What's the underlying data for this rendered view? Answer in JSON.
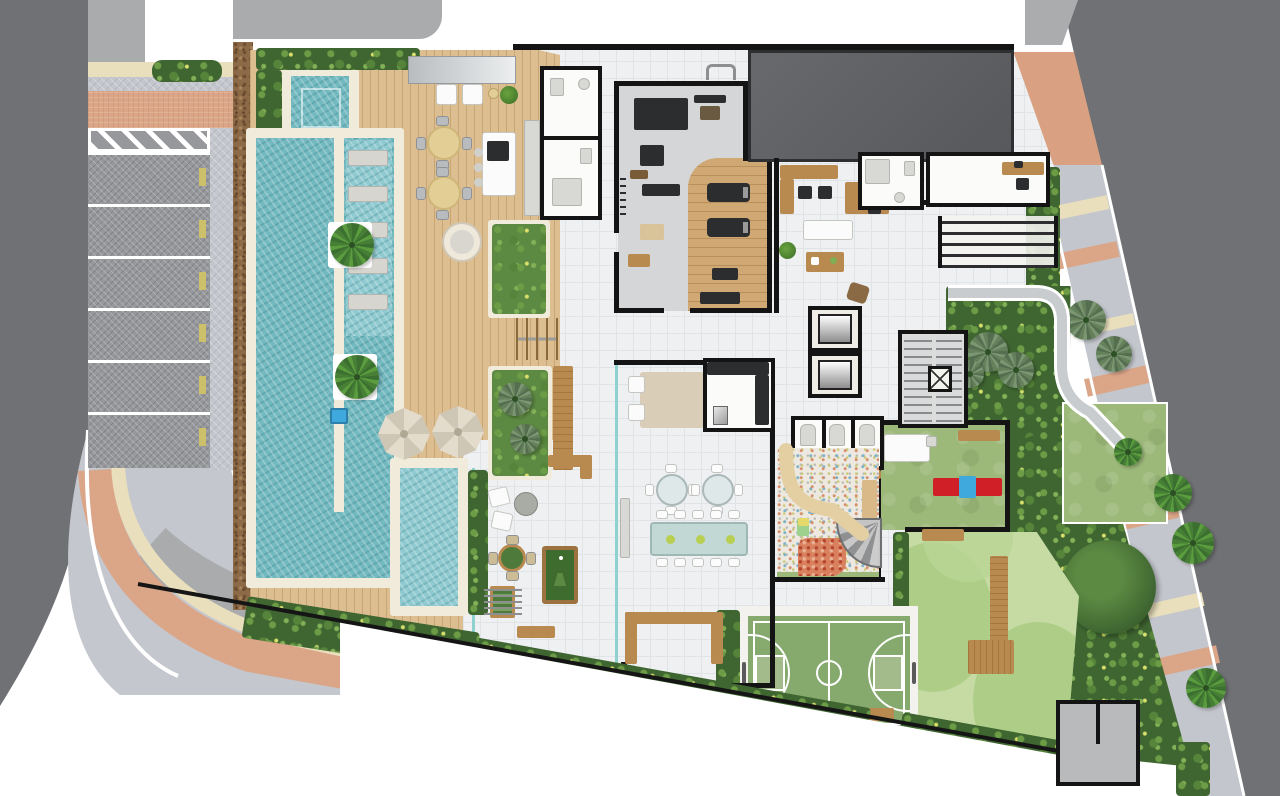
{
  "document": {
    "kind": "architectural site plan / amenity floor plan",
    "view": "top-down rendered plan",
    "visible_text": "none (drawing contains no readable labels)",
    "canvas": {
      "width_px": 1280,
      "height_px": 796
    }
  },
  "palette": {
    "street_asphalt": "#707174",
    "sidewalk_pavers": "#c3c6cc",
    "sidewalk_salmon": "#dba588",
    "sidewalk_beige": "#e9dfbc",
    "parking_stall": "#96989c",
    "curb_white": "#ffffff",
    "planting_mulch": "#8d6a47",
    "hedge_green": "#3f6631",
    "lawn_green": "#9db97a",
    "playground_green_light": "#c6dba4",
    "playground_green_dark": "#a9cb84",
    "court_green": "#86aa6e",
    "pool_water": "#73b9c0",
    "kids_pool_water": "#8fcad0",
    "pool_coping": "#f1ebdb",
    "timber_deck": "#dcbe90",
    "interior_tile": "#eef0f2",
    "gym_floor": "#d5d6d7",
    "gym_timber": "#cfa873",
    "tower_slab": "#5e6063",
    "wall_black": "#141414",
    "glass_rail_teal": "#8ed1cf",
    "wood_furniture": "#b98a50",
    "dark_furniture": "#2c2d2f",
    "play_red": "#d01f26",
    "play_blue": "#3fa8dc",
    "boundary_line": "#151515"
  },
  "object_counts": {
    "parking_stalls": 6,
    "in_pool_loungers": 5,
    "deck_parasols": 2,
    "outdoor_dining_tables": 2,
    "party_room_round_tables": 2,
    "party_room_long_table_seats": 10,
    "elevator_cars": 2,
    "changing_cabins": 3,
    "treadmills": 2,
    "sidewalk_palm_trees": 4,
    "garden_palm_clusters": 5
  },
  "areas": {
    "street-left": {
      "title": "Street (west)"
    },
    "street-right": {
      "title": "Street (east, diagonal)"
    },
    "sidewalk-left": {
      "title": "Curved sidewalk with paver, beige and salmon bands"
    },
    "sidewalk-right": {
      "title": "Palm-lined sidewalk with crossing color bands"
    },
    "parking": {
      "title": "Visitor parking - 6 stalls plus hatched no-parking zone"
    },
    "entrance-plaza": {
      "title": "Salmon paved entrance plaza"
    },
    "mulch-border": {
      "title": "Planting strip (mulch)"
    },
    "pool-deck": {
      "title": "Timber pool deck"
    },
    "spa": {
      "title": "Spa / plunge pool"
    },
    "main-pool": {
      "title": "Swimming pool with submerged lounger shelf"
    },
    "kids-pool": {
      "title": "Children's pool"
    },
    "outdoor-dining": {
      "title": "Deck dining tables"
    },
    "pool-bar": {
      "title": "Barbecue / bar island"
    },
    "pool-bathrooms": {
      "title": "Pool support bathrooms"
    },
    "glass-canopy": {
      "title": "Glass canopy"
    },
    "planters": {
      "title": "Raised garden planters"
    },
    "gym": {
      "title": "Fitness room (rubber + timber floor)"
    },
    "tower-slab": {
      "title": "Tower footprint above (projection)"
    },
    "coworking": {
      "title": "Coworking / lounge with desks and sofa"
    },
    "wc-top": {
      "title": "Restroom"
    },
    "office": {
      "title": "Administration office"
    },
    "pergola": {
      "title": "Slatted pergola"
    },
    "stairs": {
      "title": "Fire stair with service lift"
    },
    "elevators": {
      "title": "Elevator bank (2 cars)"
    },
    "party-room": {
      "title": "Party room - lounge, two round tables, long banquet table"
    },
    "party-kitchen": {
      "title": "Support kitchen"
    },
    "changing-rooms": {
      "title": "Shower cabins (3)"
    },
    "kids-playroom": {
      "title": "Kids play terrace with shell slide and mosaic floor"
    },
    "lawn-play": {
      "title": "Play lawn with seesaw"
    },
    "playground": {
      "title": "Playground with wavy safety surface and timber decks"
    },
    "sports-court": {
      "title": "Multi-sport court"
    },
    "games-terrace": {
      "title": "Games terrace - billiards, foosball, card table"
    },
    "garden-right": {
      "title": "Landscaped garden with palms"
    },
    "garden-ramp": {
      "title": "Curved accessible garden ramp"
    },
    "big-tree": {
      "title": "Large existing tree"
    },
    "utility-room": {
      "title": "Utility / service room"
    },
    "boundary": {
      "title": "Property boundary line"
    }
  }
}
